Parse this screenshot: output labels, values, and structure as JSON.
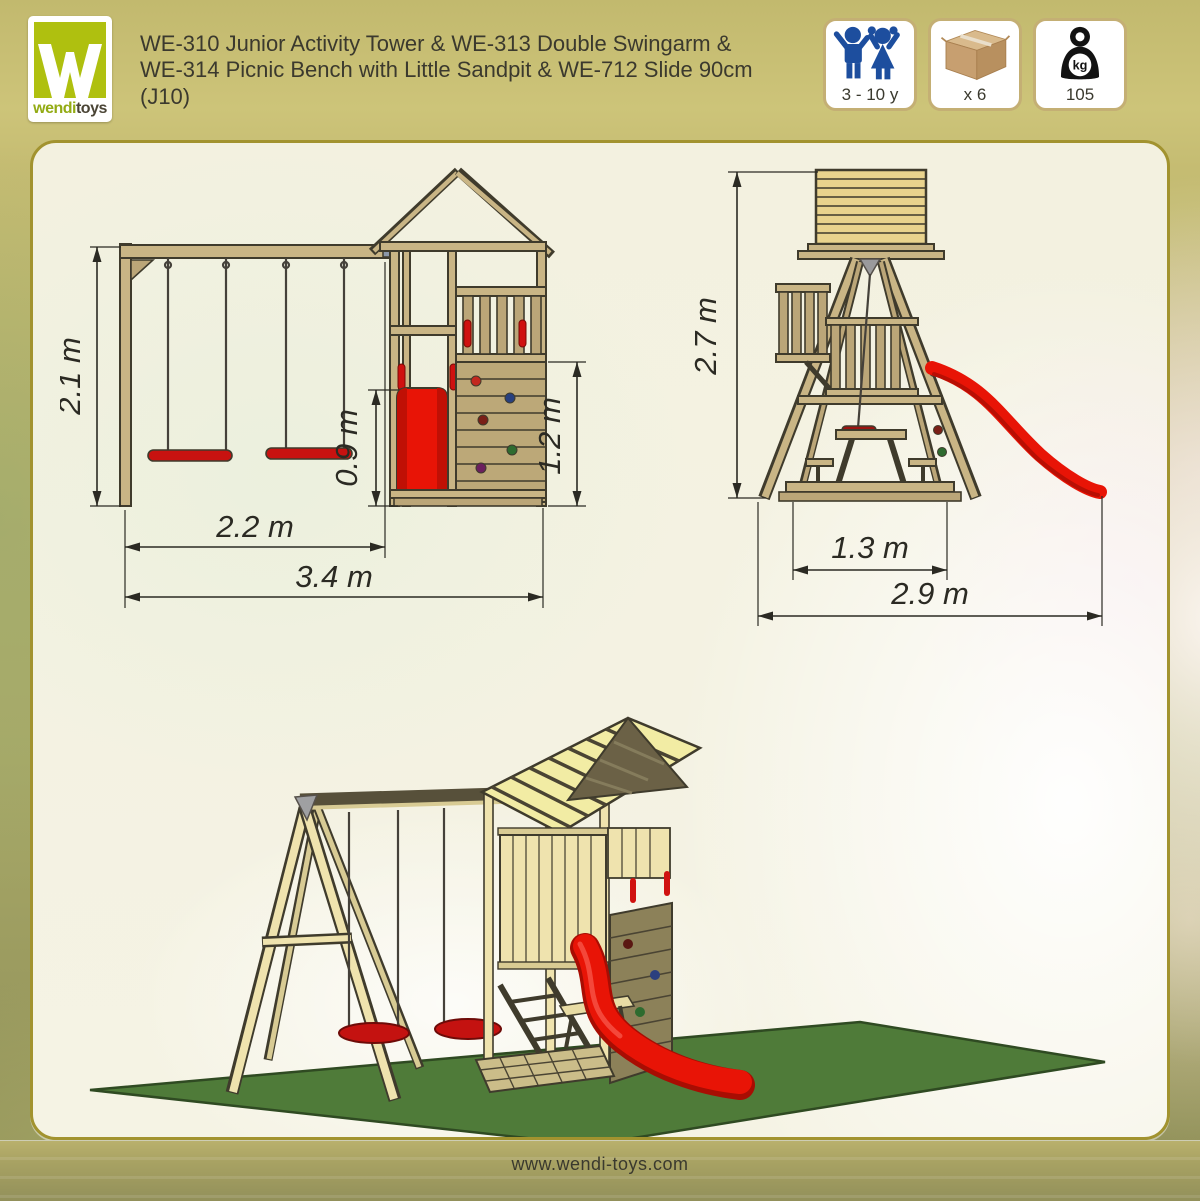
{
  "brand": {
    "logo_word_1": "wendi",
    "logo_word_2": "toys"
  },
  "header": {
    "title_lines": [
      "WE-310 Junior Activity Tower & WE-313 Double Swingarm &",
      "WE-314 Picnic Bench with Little Sandpit & WE-712 Slide 90cm",
      "(J10)"
    ],
    "badges": [
      {
        "id": "age-range",
        "icon": "children-icon",
        "label": "3 - 10 y"
      },
      {
        "id": "package-count",
        "icon": "box-icon",
        "label": "x 6"
      },
      {
        "id": "weight",
        "icon": "weight-kg-icon",
        "icon_text": "kg",
        "label": "105"
      }
    ]
  },
  "diagrams": {
    "side_view": {
      "dimensions": {
        "frame_height": "2.1 m",
        "slide_height": "0.9 m",
        "wall_height": "1.2 m",
        "swing_width": "2.2 m",
        "total_width": "3.4 m"
      }
    },
    "front_view": {
      "dimensions": {
        "tower_height": "2.7 m",
        "base_width": "1.3 m",
        "total_depth": "2.9 m"
      }
    }
  },
  "footer": {
    "website": "www.wendi-toys.com"
  },
  "colors": {
    "panel_border": "#A2932F",
    "badge_border": "#C4AF74",
    "logo_green": "#AFC00F",
    "icon_blue": "#1D4E9E",
    "slide_red": "#E81406",
    "mat_green": "#4F7B39",
    "wood": "#C9B585",
    "text_dark": "#3A392E"
  }
}
